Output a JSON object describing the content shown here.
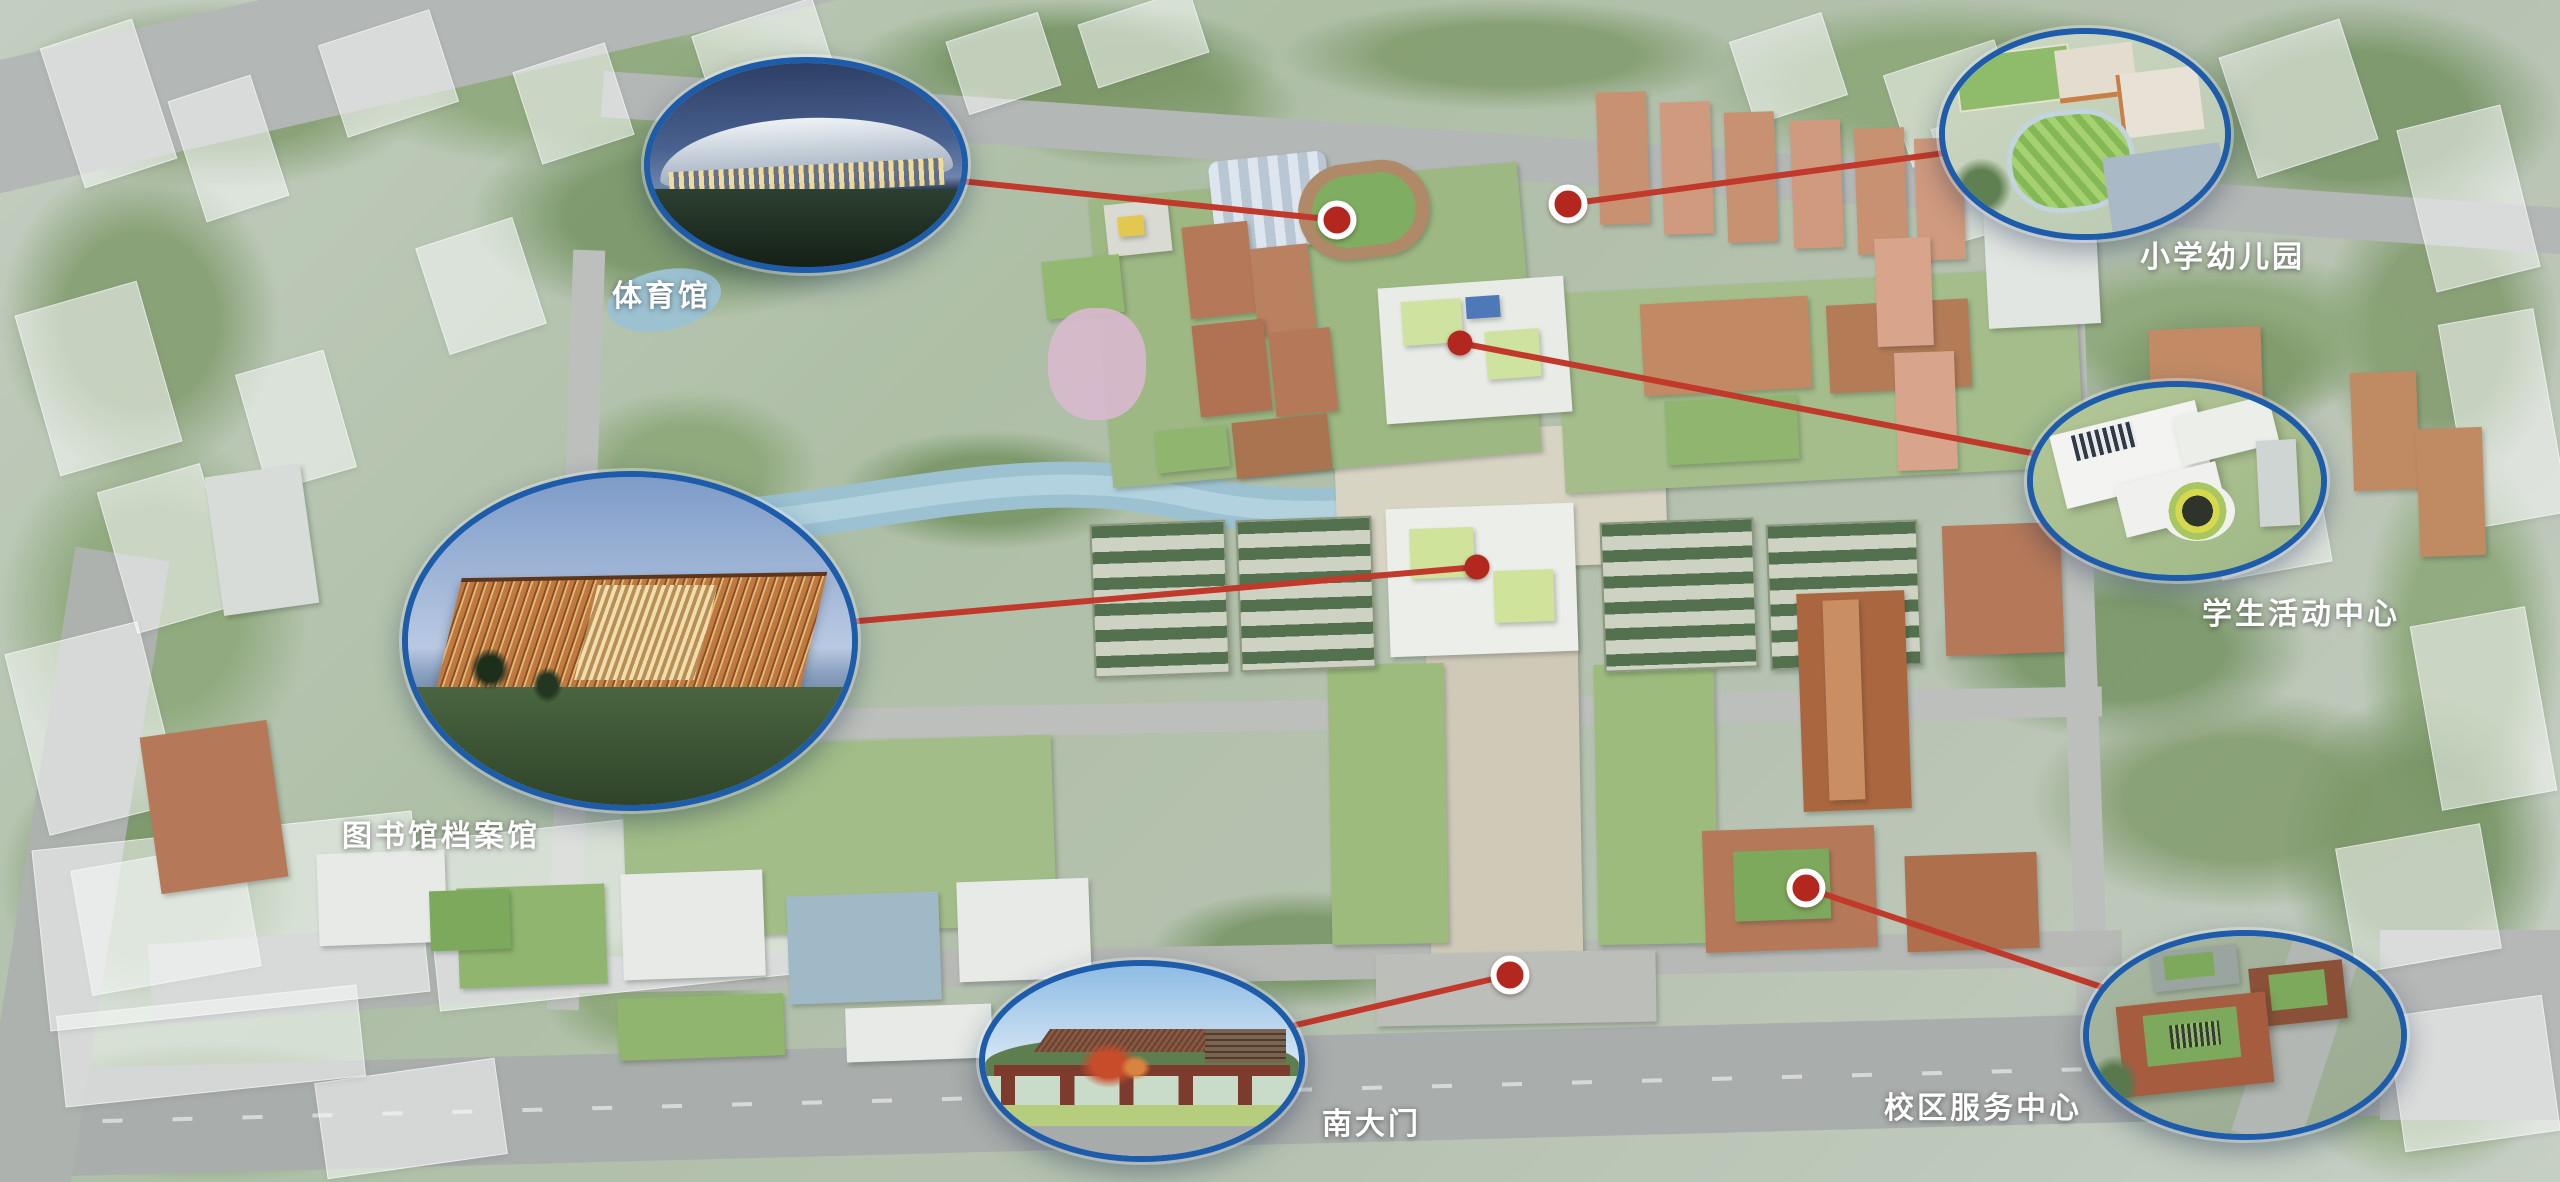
{
  "scene": {
    "type": "campus-masterplan-aerial-rendering",
    "description_labels_visible_only": true
  },
  "colors": {
    "connector_red": "#c0392b",
    "marker_red": "#b3271f",
    "marker_ring_white": "#ffffff",
    "callout_border_blue": "#1d5bab",
    "label_text": "#ffffff"
  },
  "callouts": [
    {
      "id": "gymnasium",
      "label": "体育馆",
      "ellipse": {
        "cx": 806,
        "cy": 165,
        "rx": 162,
        "ry": 108
      },
      "label_pos": {
        "x": 612,
        "y": 280
      },
      "marker": {
        "x": 1337,
        "y": 220,
        "ring": true
      }
    },
    {
      "id": "primary-school-kindergarten",
      "label": "小学幼儿园",
      "ellipse": {
        "cx": 2085,
        "cy": 134,
        "rx": 146,
        "ry": 106
      },
      "label_pos": {
        "x": 2140,
        "y": 241
      },
      "marker": {
        "x": 1568,
        "y": 204,
        "ring": true
      }
    },
    {
      "id": "student-activity-center",
      "label": "学生活动中心",
      "ellipse": {
        "cx": 2177,
        "cy": 481,
        "rx": 150,
        "ry": 100
      },
      "label_pos": {
        "x": 2202,
        "y": 598
      },
      "marker": {
        "x": 1460,
        "y": 343,
        "ring": false
      }
    },
    {
      "id": "library-archives",
      "label": "图书馆档案馆",
      "ellipse": {
        "cx": 630,
        "cy": 641,
        "rx": 228,
        "ry": 170
      },
      "label_pos": {
        "x": 342,
        "y": 820
      },
      "marker": {
        "x": 1477,
        "y": 567,
        "ring": false
      }
    },
    {
      "id": "south-gate",
      "label": "南大门",
      "ellipse": {
        "cx": 1142,
        "cy": 1061,
        "rx": 163,
        "ry": 101
      },
      "label_pos": {
        "x": 1322,
        "y": 1108
      },
      "marker": {
        "x": 1510,
        "y": 975,
        "ring": true
      }
    },
    {
      "id": "campus-service-center",
      "label": "校区服务中心",
      "ellipse": {
        "cx": 2245,
        "cy": 1035,
        "rx": 162,
        "ry": 105
      },
      "label_pos": {
        "x": 1884,
        "y": 1092
      },
      "marker": {
        "x": 1806,
        "y": 888,
        "ring": true
      }
    }
  ]
}
